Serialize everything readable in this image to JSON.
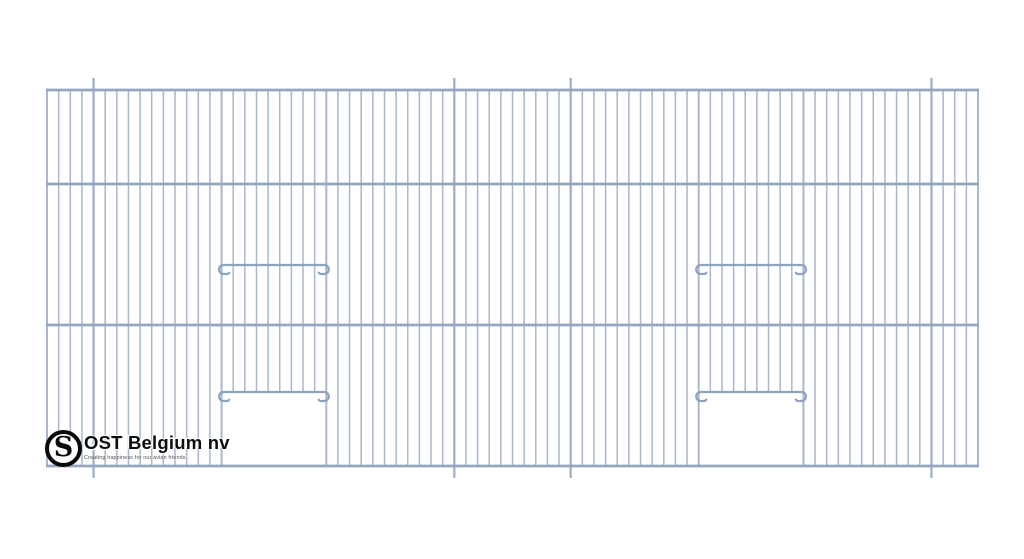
{
  "page": {
    "background": "#ffffff"
  },
  "branding": {
    "company_name": "OST Belgium nv",
    "tagline": "Creating happiness for our avian friends",
    "monogram": "S"
  },
  "drawing": {
    "subject": "cage-front-panel-wire-grid",
    "colors": {
      "wire": "#aab7cd",
      "thick_wire": "#9dadc7",
      "rail": "#95a6c1",
      "rod": "#8fa2bf"
    },
    "panel": {
      "left": 47,
      "top": 90,
      "right": 978,
      "bottom": 466
    },
    "rails_y": [
      90,
      184,
      325,
      466
    ],
    "wires": {
      "count": 81,
      "pitch": 11.6375,
      "thick_indices": [
        4,
        35,
        45,
        76
      ],
      "tick_extension": 12
    },
    "perch_rods": [
      {
        "y": 265,
        "from_wire": 15,
        "to_wire": 24
      },
      {
        "y": 265,
        "from_wire": 56,
        "to_wire": 65
      }
    ],
    "doors": [
      {
        "bar_y": 392,
        "from_wire": 15,
        "to_wire": 24
      },
      {
        "bar_y": 392,
        "from_wire": 56,
        "to_wire": 65
      }
    ]
  }
}
